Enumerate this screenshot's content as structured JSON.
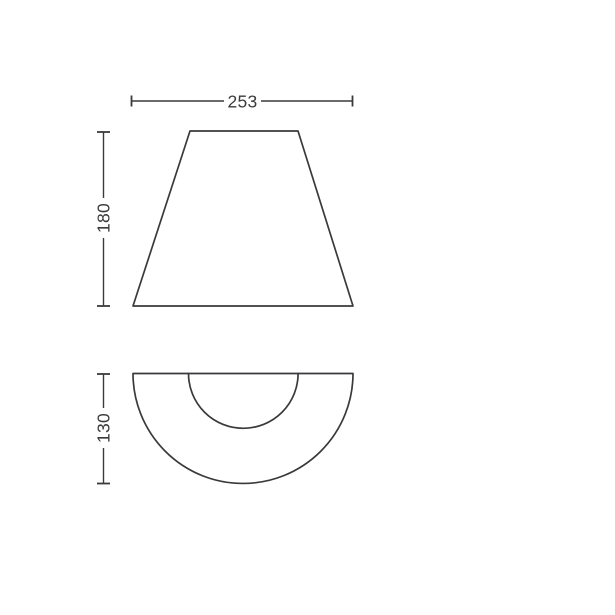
{
  "diagram": {
    "kind": "technical-dimension-drawing",
    "background_color": "#ffffff",
    "line_color": "#3a3a3c",
    "views": [
      {
        "id": "front-view",
        "shape": "trapezoid"
      },
      {
        "id": "bottom-view",
        "shape": "semicircle-with-inner-semicircle"
      }
    ],
    "dimensions": {
      "width": {
        "label": "253",
        "orientation": "horizontal"
      },
      "height": {
        "label": "180",
        "orientation": "vertical"
      },
      "depth": {
        "label": "130",
        "orientation": "vertical"
      }
    }
  }
}
